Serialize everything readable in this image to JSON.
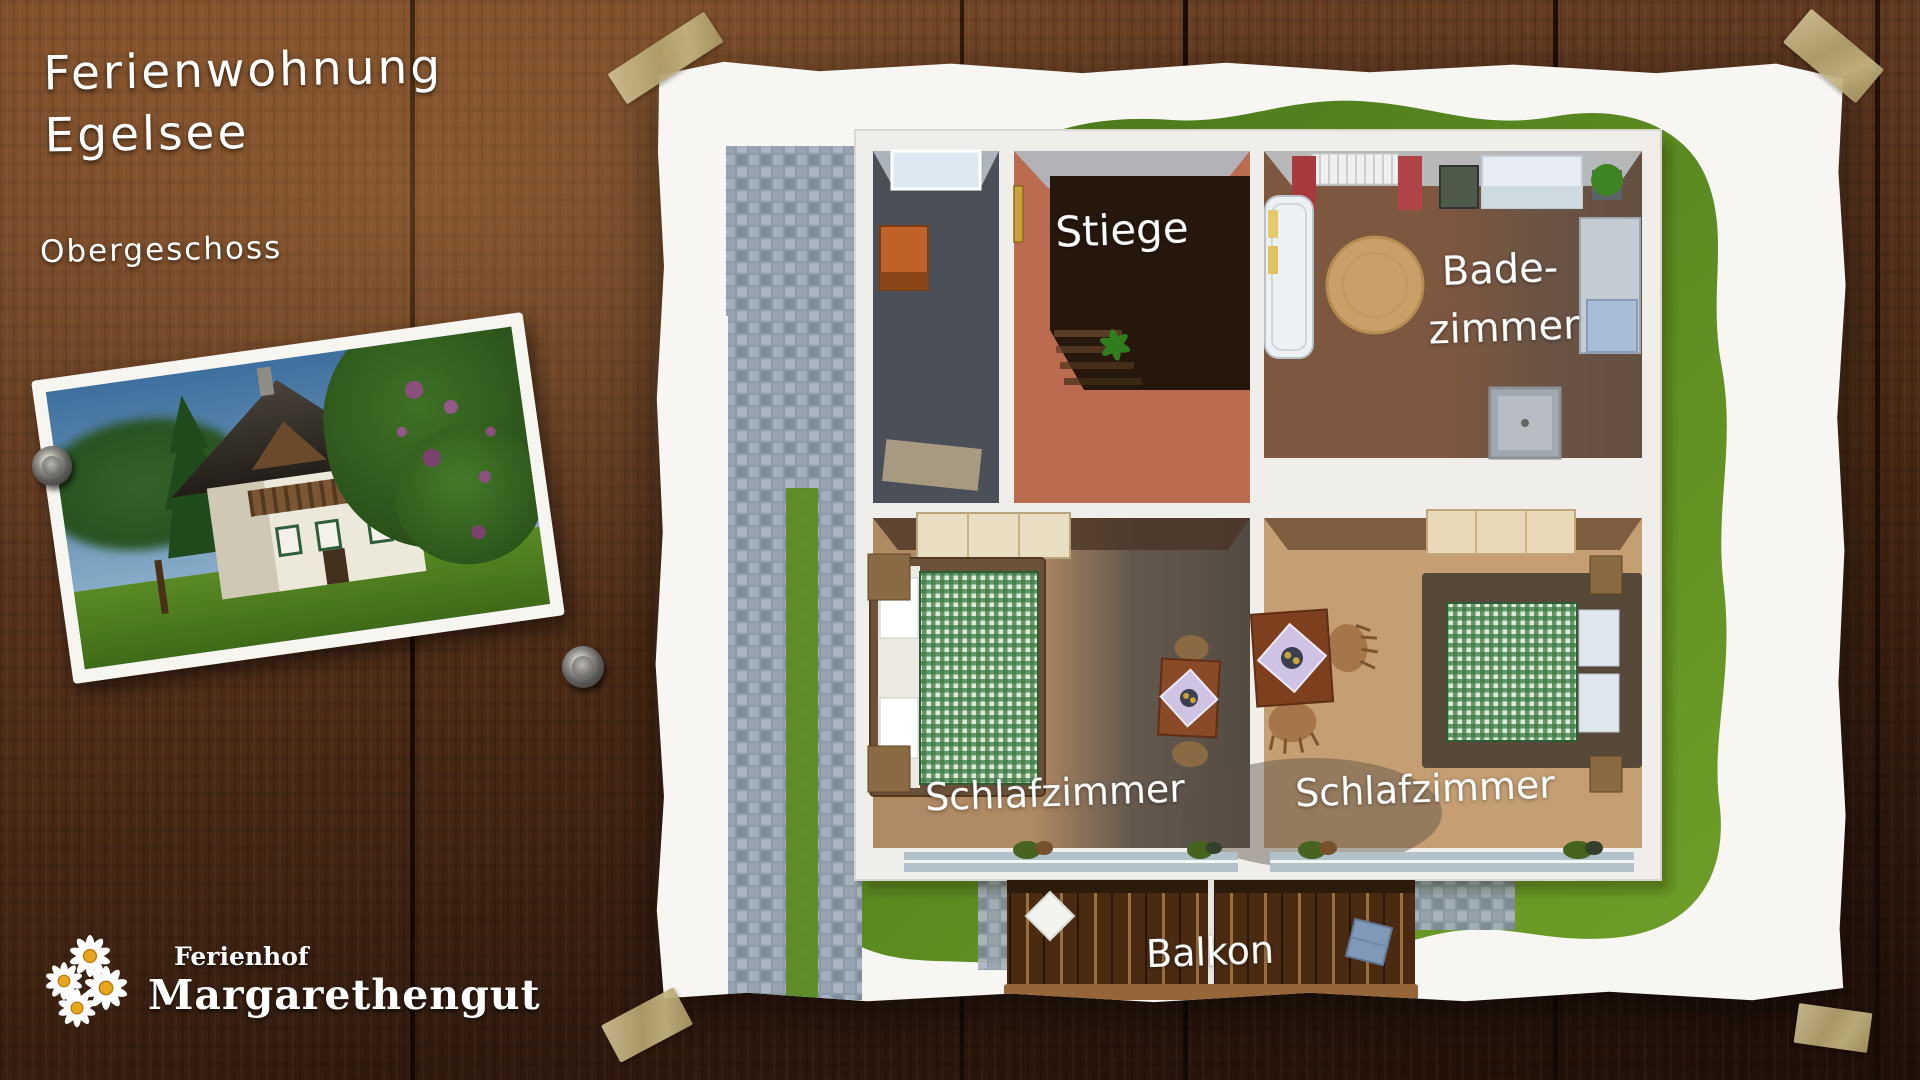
{
  "header": {
    "title_line1": "Ferienwohnung",
    "title_line2": "Egelsee",
    "subtitle": "Obergeschoss"
  },
  "logo": {
    "farm_label": "Ferienhof",
    "farm_name": "Margarethengut"
  },
  "plan": {
    "labels": {
      "stairs": "Stiege",
      "bathroom_line1": "Bade-",
      "bathroom_line2": "zimmer",
      "bedroom_left": "Schlafzimmer",
      "bedroom_right": "Schlafzimmer",
      "balcony": "Balkon"
    }
  },
  "icons": {
    "pin": "push-pin",
    "tape": "adhesive-tape-strip",
    "daisy": "daisy-flower"
  },
  "palette": {
    "wood_dark": "#24130a",
    "wood_mid": "#56311b",
    "wood_light": "#7b4b2b",
    "paper": "#f7f6f3",
    "tape": "#b5a678",
    "grass_dark": "#47741a",
    "grass_light": "#6f9f28",
    "stone": "#8d9aa8",
    "wall": "#efeeea",
    "terracotta": "#bb6c50",
    "floor_brown": "#7d5740",
    "floor_dark_slate": "#4b5058",
    "floor_tan_left": "#b08a63",
    "floor_tan_right": "#c59f73",
    "bed_green": "#3a7a44",
    "balcony_deck": "#4b2a12",
    "label_text": "#ffffff"
  }
}
